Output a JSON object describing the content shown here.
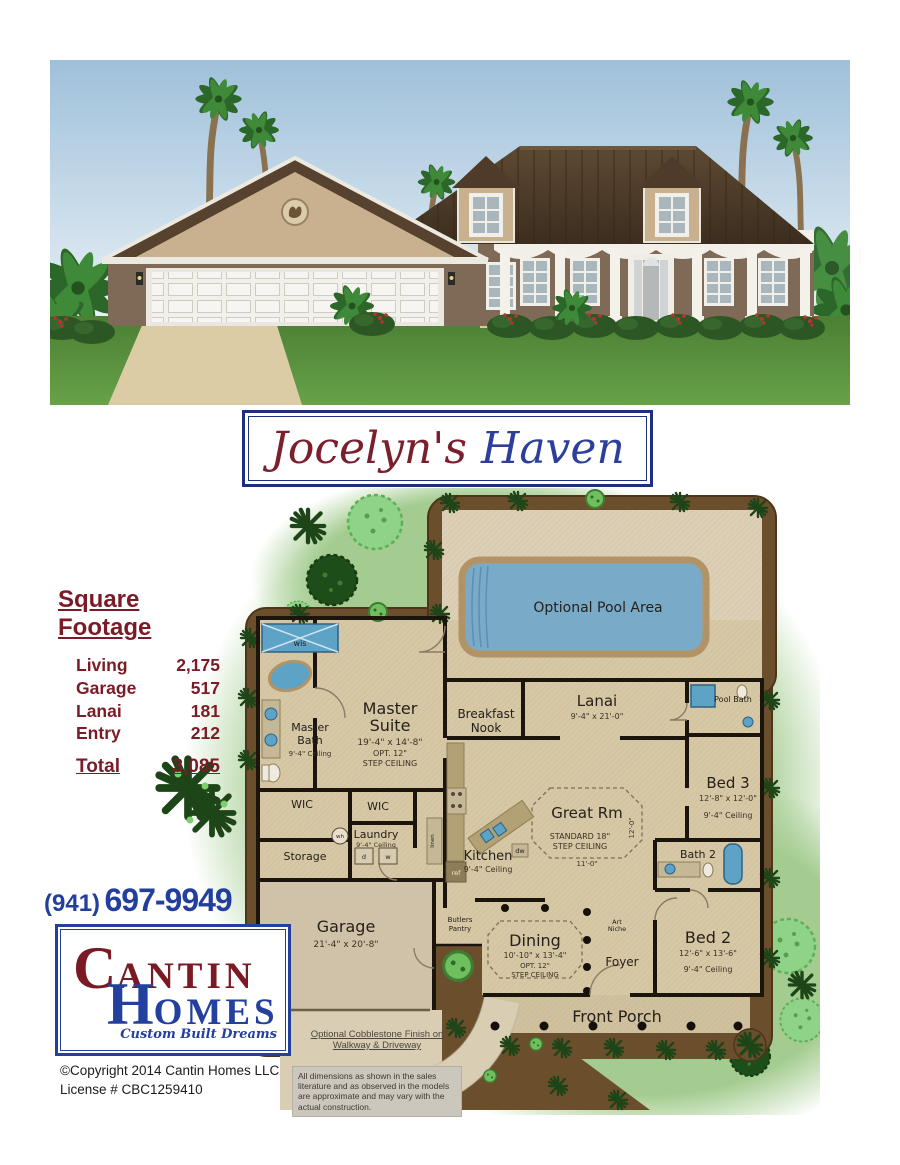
{
  "title": {
    "part1": "Jocelyn's",
    "part2": "Haven"
  },
  "sqft": {
    "heading": "Square Footage",
    "rows": [
      {
        "label": "Living",
        "value": "2,175"
      },
      {
        "label": "Garage",
        "value": "517"
      },
      {
        "label": "Lanai",
        "value": "181"
      },
      {
        "label": "Entry",
        "value": "212"
      }
    ],
    "total_label": "Total",
    "total_value": "3,085"
  },
  "contact": {
    "phone_area": "(941)",
    "phone_number": "697-9949"
  },
  "logo": {
    "c": "C",
    "antin": "ANTIN",
    "h": "H",
    "omes": "OMES",
    "tagline": "Custom Built Dreams"
  },
  "footer": {
    "copyright": "©Copyright 2014 Cantin Homes LLC",
    "license": "License # CBC1259410"
  },
  "plan": {
    "pool_label": "Optional Pool Area",
    "rooms": {
      "master_bath": {
        "lines": [
          "Master",
          "Bath"
        ],
        "ceiling": "9'-4\" Ceiling"
      },
      "master_suite": {
        "lines": [
          "Master",
          "Suite"
        ],
        "dims": "19'-4\" x 14'-8\"",
        "opt": "OPT. 12\"",
        "step": "STEP CEILING"
      },
      "breakfast_nook": {
        "lines": [
          "Breakfast",
          "Nook"
        ]
      },
      "lanai": {
        "name": "Lanai",
        "dims": "9'-4\" x 21'-0\""
      },
      "pool_bath": {
        "name": "Pool Bath"
      },
      "bed3": {
        "name": "Bed 3",
        "dims": "12'-8\" x 12'-0\"",
        "ceiling": "9'-4\" Ceiling"
      },
      "great_rm": {
        "name": "Great Rm",
        "std": "STANDARD 18\"",
        "step": "STEP CEILING",
        "dim_v": "12'-0\"",
        "dim_h": "11'-0\""
      },
      "wic1": {
        "name": "WIC"
      },
      "wic2": {
        "name": "WIC"
      },
      "laundry": {
        "name": "Laundry",
        "ceiling": "9'-4\" Ceiling"
      },
      "storage": {
        "name": "Storage"
      },
      "kitchen": {
        "name": "Kitchen",
        "ceiling": "9'-4\" Ceiling"
      },
      "garage": {
        "name": "Garage",
        "dims": "21'-4\" x 20'-8\""
      },
      "butlers": {
        "lines": [
          "Butlers",
          "Pantry"
        ]
      },
      "dining": {
        "name": "Dining",
        "dims": "10'-10\" x 13'-4\"",
        "opt": "OPT. 12\"",
        "step": "STEP CEILING"
      },
      "art_niche": {
        "lines": [
          "Art",
          "Niche"
        ]
      },
      "foyer": {
        "name": "Foyer"
      },
      "bath2": {
        "name": "Bath 2"
      },
      "bed2": {
        "name": "Bed 2",
        "dims": "12'-6\" x 13'-6\"",
        "ceiling": "9'-4\" Ceiling"
      },
      "front_porch": {
        "name": "Front Porch"
      }
    },
    "fixtures": {
      "wis": "wis",
      "wh": "wh",
      "dryer": "d",
      "washer": "w",
      "ref": "ref",
      "dw": "dw",
      "linen": "linen"
    },
    "notes": {
      "cobblestone": "Optional Cobblestone Finish on Walkway & Driveway",
      "disclaimer": "All dimensions as shown in the sales literature and as observed in the models are approximate and may vary with the actual construction."
    }
  },
  "colors": {
    "maroon": "#7b1b27",
    "navy": "#23409e",
    "pool_blue": "#79abc9",
    "plan_brown": "#6b4e2c"
  }
}
